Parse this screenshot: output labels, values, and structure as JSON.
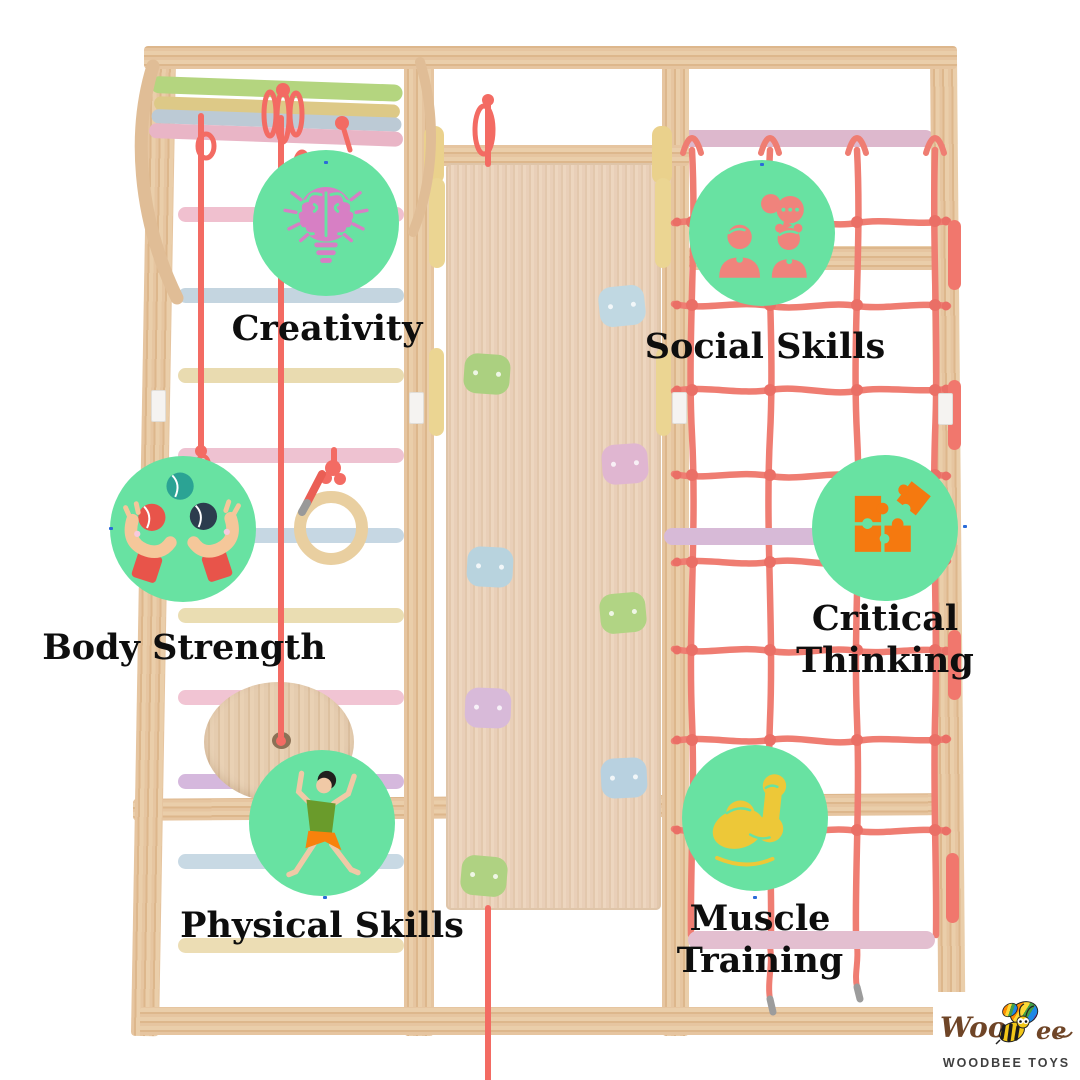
{
  "page": {
    "width": 1080,
    "height": 1080,
    "background": "#ffffff",
    "subject": "Wooden kids climbing frame (jungle gym) product infographic with six benefit callouts"
  },
  "palette": {
    "callout_circle": "#68e2a2",
    "label_text": "#0e0e0e",
    "wood": "#dfb78c",
    "rope_red": "#f2564c",
    "net_red": "#ed6a5e"
  },
  "features": [
    {
      "label": "Creativity",
      "icon": "lightbulb-brain-icon",
      "icon_color": "#d77fc4"
    },
    {
      "label": "Social Skills",
      "icon": "children-talking-icon",
      "icon_color": "#f0837c"
    },
    {
      "label": "Body Strength",
      "icon": "juggling-hands-icon",
      "icon_color": "#e8544a"
    },
    {
      "label": "Critical Thinking",
      "lines": [
        "Critical",
        "Thinking"
      ],
      "icon": "puzzle-pieces-icon",
      "icon_color": "#f5790f"
    },
    {
      "label": "Physical Skills",
      "icon": "jumping-child-icon",
      "icon_color": "#6a9b2b"
    },
    {
      "label": "Muscle Training",
      "icon": "flexed-bicep-icon",
      "icon_color": "#edc838"
    }
  ],
  "brand": {
    "name": "Woodbee",
    "display_start": "Woo",
    "display_end": "ee",
    "caption": "WOODBEE TOYS"
  }
}
